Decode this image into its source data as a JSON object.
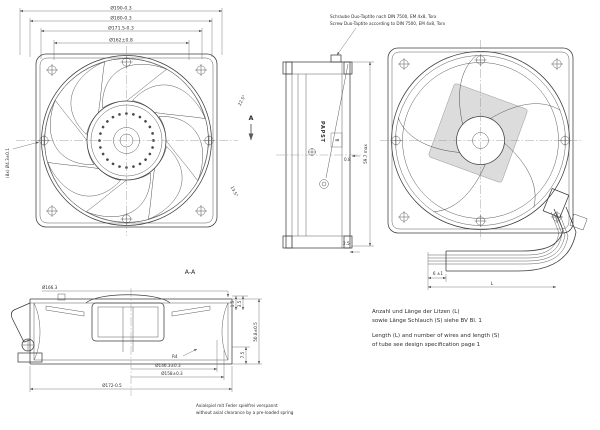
{
  "front_view": {
    "section_label": "A",
    "dims": {
      "d190": "Ø190-0.3",
      "d180": "Ø180-0.3",
      "d171_5": "Ø171.5-0.3",
      "d162": "Ø162±0.8",
      "holes": "(8x) Ø4.3±0.1",
      "angle_top": "22.5°",
      "angle_bottom": "13.5°"
    }
  },
  "side_view": {
    "screw_note_de": "Schraube Duo-Taptite nach DIN 7500, EM 4x8, Torx",
    "screw_note_en": "Screw Duo-Taptite according to DIN 7500, EM 4x8, Torx",
    "brand": "PAPST",
    "dims": {
      "boxed": "8",
      "gap": "0.8",
      "offset": "2.5",
      "depth": "59.7 max"
    }
  },
  "rear_view": {
    "dims": {
      "strip": "6 ±1",
      "length": "L"
    }
  },
  "section_view": {
    "label": "A-A",
    "dims": {
      "d166_3": "Ø166.3",
      "t1": "1.5",
      "t2": "3.5",
      "height": "50.8±0.5",
      "d7_5": "7.5",
      "radius": "R4",
      "d146_3": "Ø146.3±0.3",
      "d158": "Ø158±0.3",
      "d172": "Ø172-0.5"
    }
  },
  "notes": {
    "wires_de_1": "Anzahl und Länge der Litzen (L)",
    "wires_de_2": "sowie Länge Schlauch (S) siehe BV Bl. 1",
    "wires_en_1": "Length (L) and number of wires and length (S)",
    "wires_en_2": "of tube see design specification page 1",
    "axial_de": "Axialspiel mit Feder spielfrei verspannt",
    "axial_en": "without axial clearance by a pre-loaded spring"
  },
  "colors": {
    "line": "#3c3c3c",
    "dim": "#5a5a5a",
    "label_plate": "#dcdcdc",
    "background": "#ffffff"
  }
}
